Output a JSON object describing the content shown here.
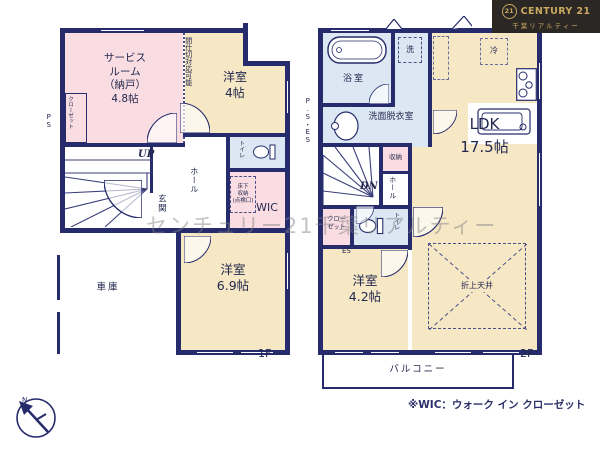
{
  "branding": {
    "badge": "21",
    "name": "CENTURY 21",
    "subtitle": "千葉リアルティー"
  },
  "watermark": "センチュリー21千葉リアルティー",
  "note": "※WIC：ウォーク イン クローゼット",
  "compass_north": "N",
  "colors": {
    "wall": "#262b6b",
    "room_beige": "#f6e7c5",
    "room_pink": "#f9dde2",
    "room_blue": "#dbe7f3",
    "logo_bg": "#2b2724",
    "logo_gold": "#c9a961",
    "watermark_gray": "#828282"
  },
  "floor1": {
    "floor_label": "1F",
    "service_room": "サービス\nルーム\n（納戸）\n4.8帖",
    "closet": "クローゼット",
    "partition_note": "間仕切対応可能",
    "bedroom4": "洋室\n4帖",
    "toilet": "トイレ",
    "up": "UP",
    "hall": "ホール",
    "entrance": "玄関",
    "underfloor_storage": "床下\n収納\n(点検口)",
    "wic": "WIC",
    "bedroom69": "洋室\n6.9帖",
    "garage": "車庫",
    "ps": "PS"
  },
  "floor2": {
    "floor_label": "2F",
    "bathroom": "浴室",
    "washer": "洗",
    "washroom": "洗面脱衣室",
    "ps_es": "P.S・ES",
    "fridge": "冷",
    "ldk": "LDK\n17.5帖",
    "dn": "DN",
    "hall": "ホール",
    "storage": "収納",
    "closet": "クロー\nゼット",
    "toilet": "トイレ",
    "es": "ES",
    "bedroom42": "洋室\n4.2帖",
    "coffered_ceiling": "折上天井",
    "balcony": "バルコニー"
  }
}
